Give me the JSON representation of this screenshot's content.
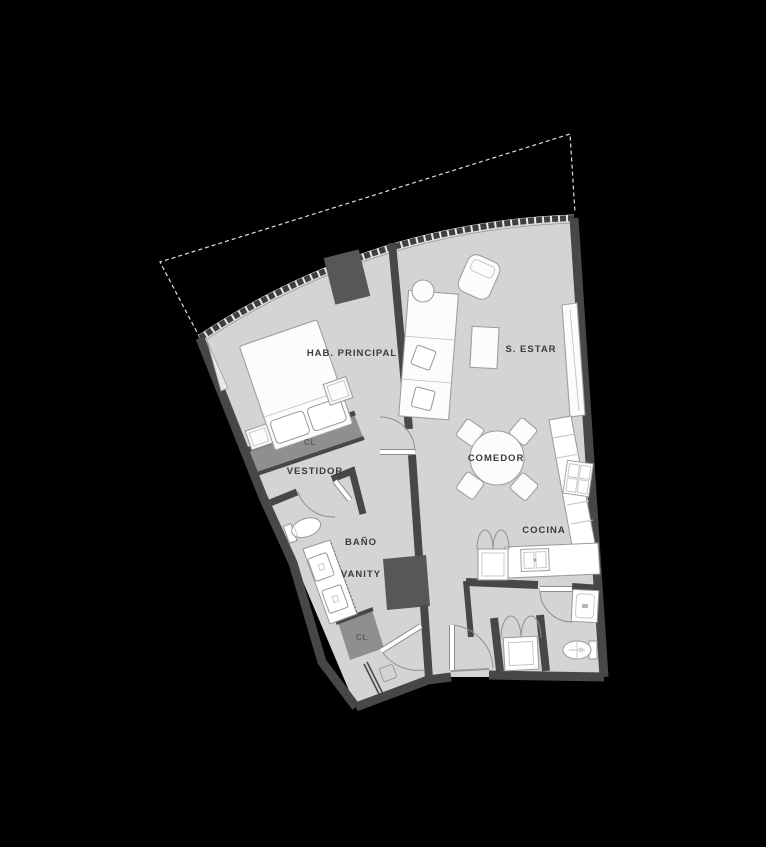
{
  "title": "Apartment unit floor plan",
  "labels": {
    "master_bedroom": "HAB. PRINCIPAL",
    "living_room": "S. ESTAR",
    "dining_room": "COMEDOR",
    "kitchen": "COCINA",
    "walk_in_closet": "VESTIDOR",
    "bathroom": "BAÑO",
    "vanity": "VANITY",
    "closet_bedroom": "CL",
    "closet_hall": "CL"
  },
  "colors": {
    "background": "#000000",
    "floor": "#d4d4d4",
    "wall": "#474747",
    "closet_band": "#8f8f8f",
    "dark_block": "#575757",
    "dashed_line": "#dedede",
    "furniture_fill": "#fcfcfc",
    "furniture_outline": "#9f9f9f",
    "label_text": "#3b3b3b"
  },
  "icon_names": [
    "bed",
    "nightstand",
    "wardrobe",
    "sofa-desk",
    "side-table",
    "armchair",
    "coffee-table",
    "tv-console",
    "dining-table",
    "dining-chair",
    "kitchen-counter",
    "stove",
    "kitchen-sink",
    "refrigerator",
    "washer",
    "toilet",
    "vanity-sinks",
    "shower",
    "door-swing",
    "window-wall",
    "entry-door",
    "bathroom-sink"
  ]
}
